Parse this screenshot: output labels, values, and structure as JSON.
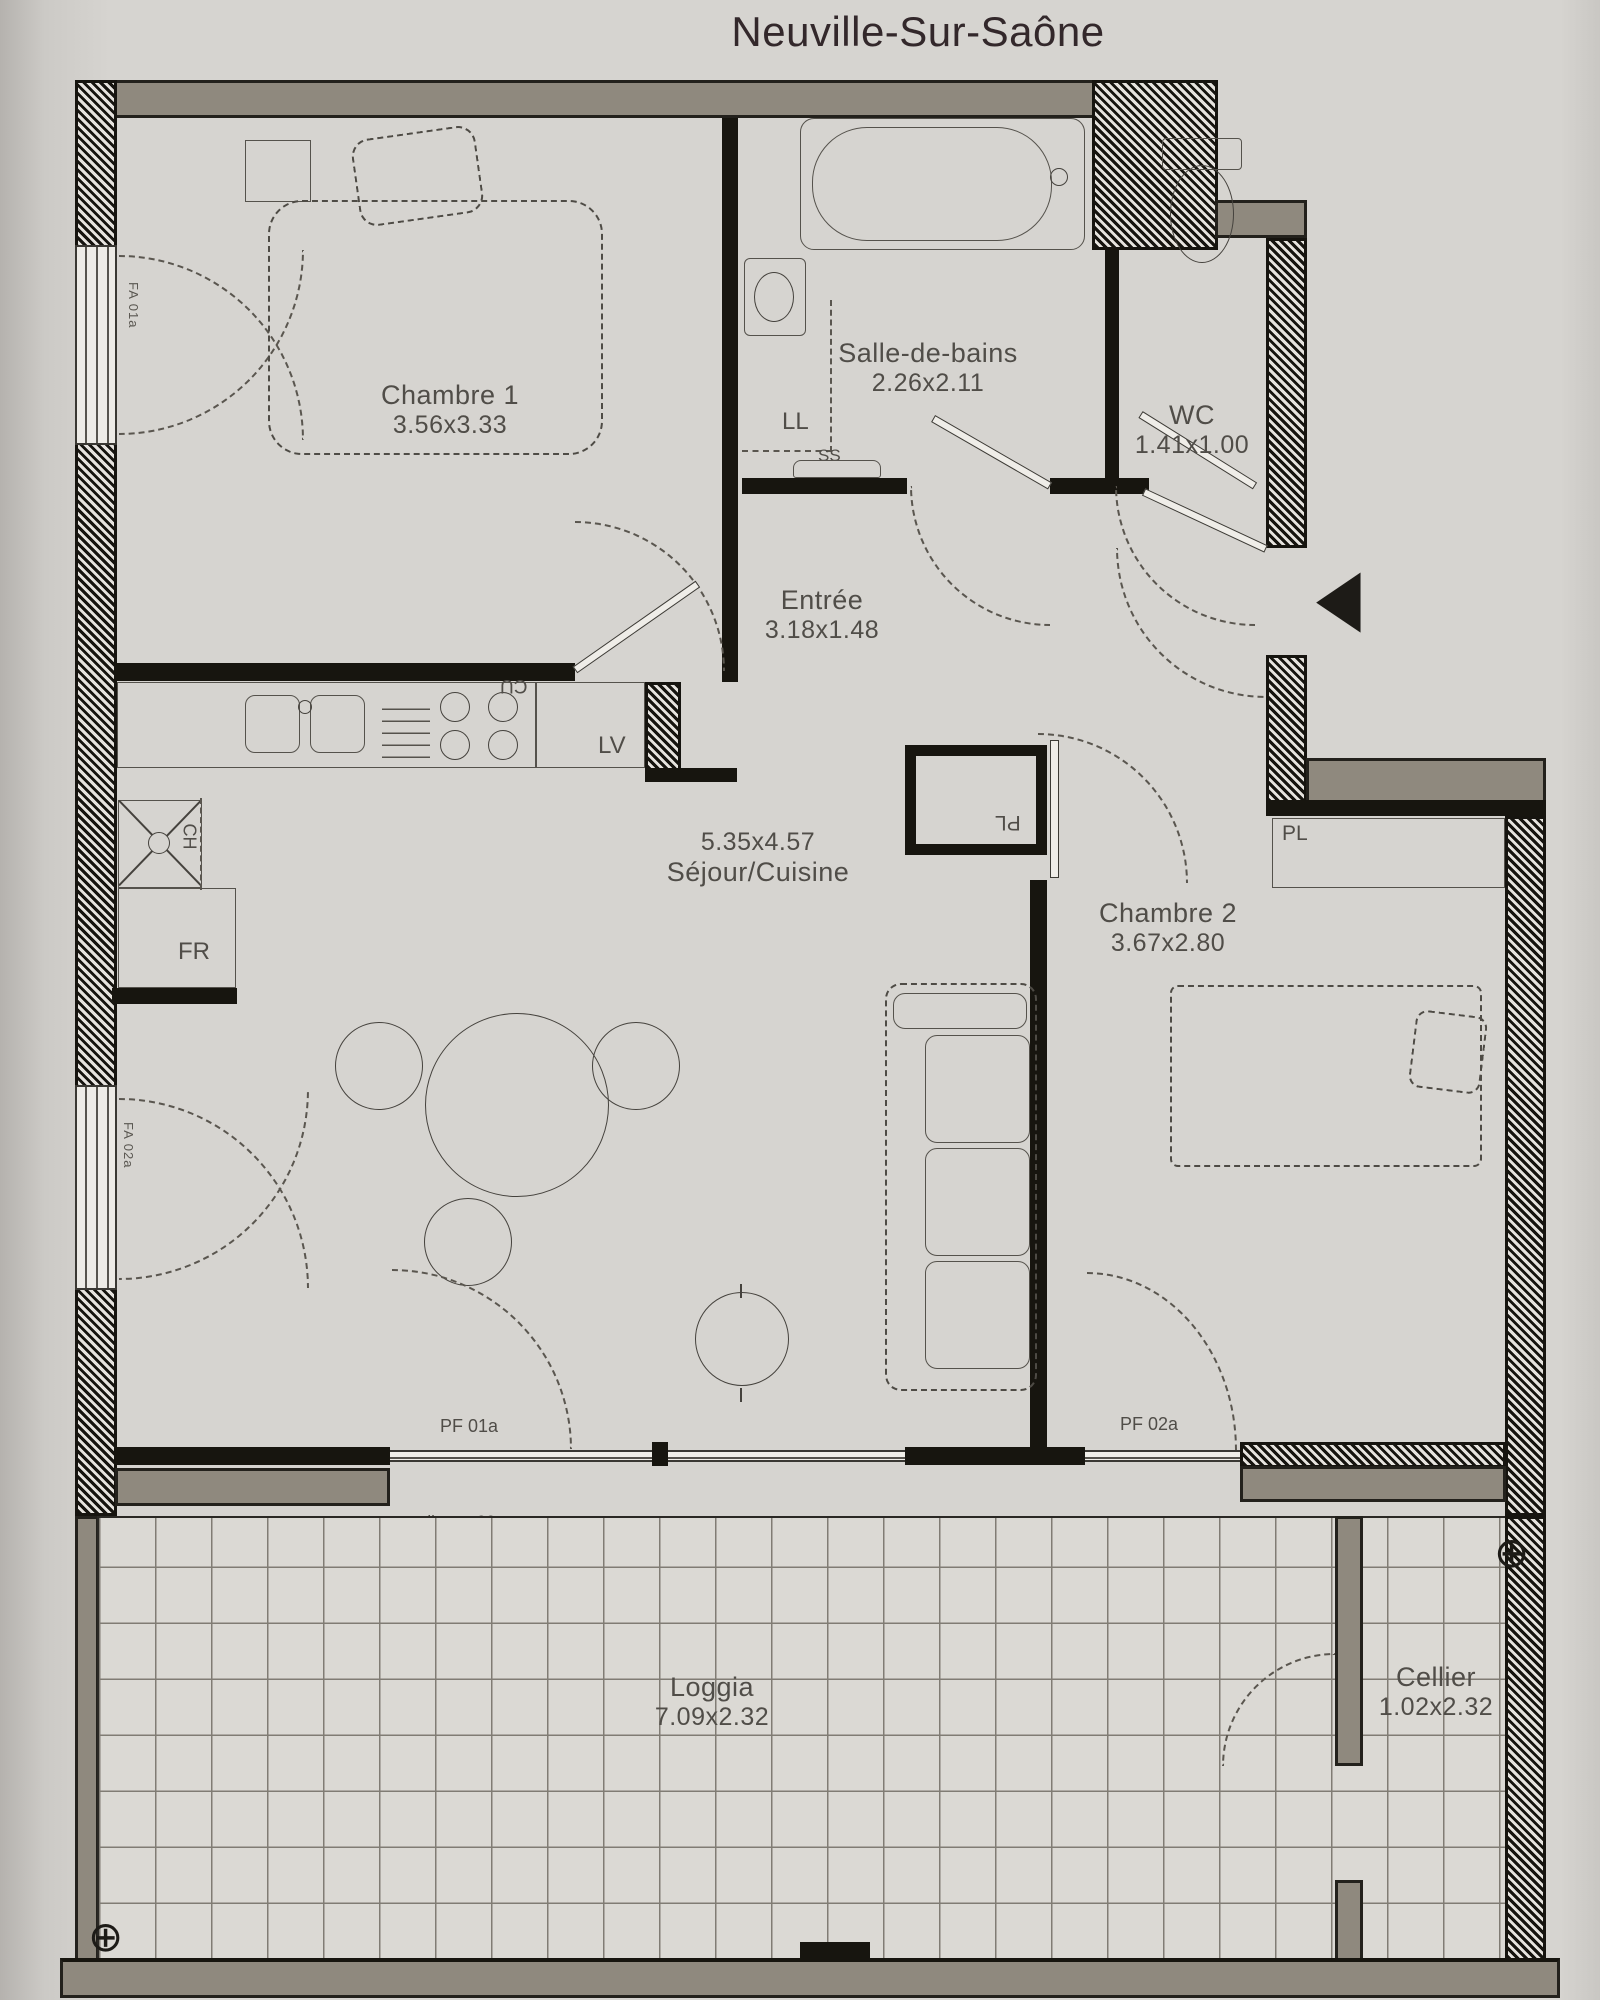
{
  "title": "Neuville-Sur-Saône",
  "rooms": {
    "chambre1": {
      "name": "Chambre 1",
      "dims": "3.56x3.33"
    },
    "salle_de_bains": {
      "name": "Salle-de-bains",
      "dims": "2.26x2.11"
    },
    "wc": {
      "name": "WC",
      "dims": "1.41x1.00"
    },
    "entree": {
      "name": "Entrée",
      "dims": "3.18x1.48"
    },
    "sejour": {
      "name": "Séjour/Cuisine",
      "dims": "5.35x4.57"
    },
    "chambre2": {
      "name": "Chambre 2",
      "dims": "3.67x2.80"
    },
    "loggia": {
      "name": "Loggia",
      "dims": "7.09x2.32"
    },
    "cellier": {
      "name": "Cellier",
      "dims": "1.02x2.32"
    }
  },
  "equipment": {
    "washer": "LL",
    "towel_dryer": "SS",
    "dishwasher": "LV",
    "cooktop": "CU",
    "boiler": "CH",
    "fridge": "FR",
    "closet_entree": "PL",
    "closet_chambre2": "PL"
  },
  "openings": {
    "loggia_door_1": "PF 01a",
    "loggia_door_2": "PF 02a",
    "window_1": "FA 01a",
    "window_2": "FA 02a",
    "threshold_note": "seuil max 20cm"
  },
  "icons": {
    "crosshair": "⊕",
    "entrance_arrow": "◀"
  },
  "colors": {
    "paper": "#d6d4d0",
    "wall_gray": "#8f897e",
    "wall_dark": "#17150f",
    "line": "#4a4742"
  }
}
